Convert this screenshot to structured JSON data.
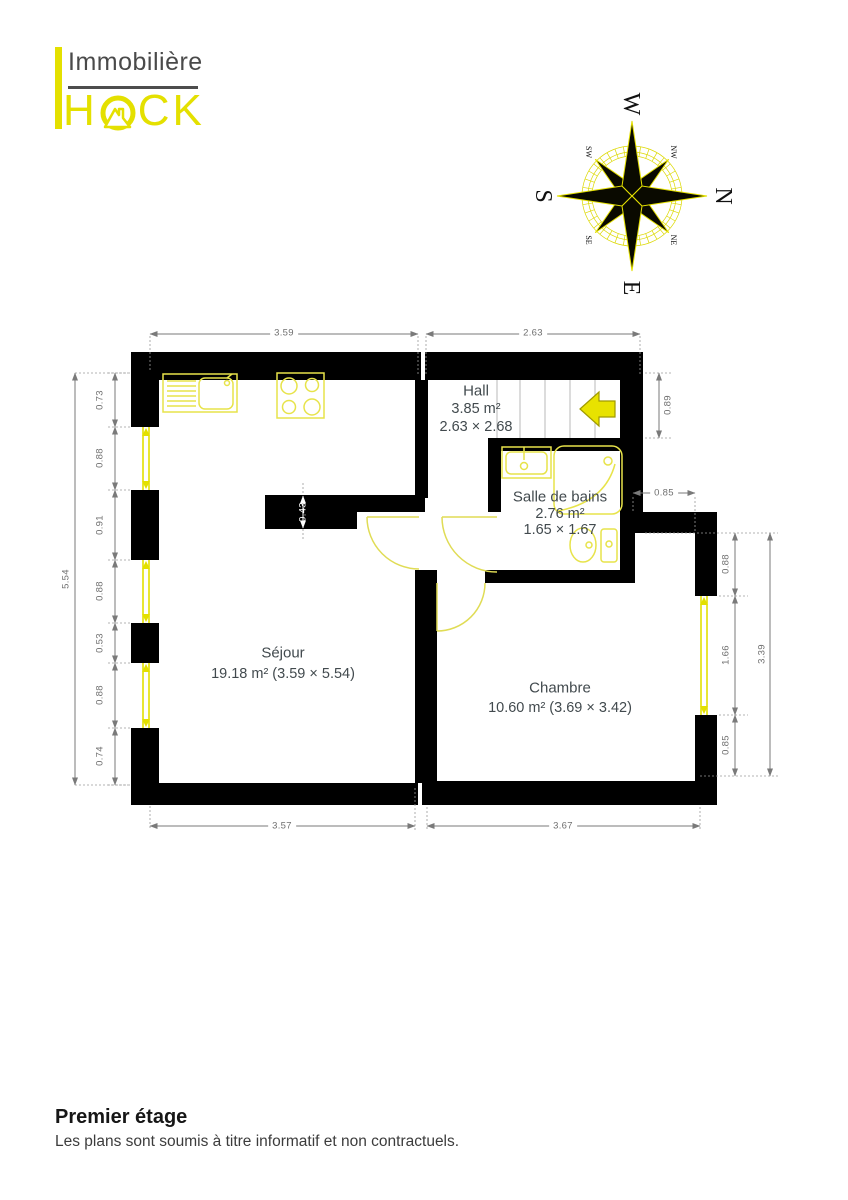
{
  "logo": {
    "line1": "Immobilière",
    "line2_h": "H",
    "line2_ck": "CK"
  },
  "compass": {
    "cardinals": [
      "N",
      "E",
      "S",
      "W"
    ],
    "intercardinals": [
      "NE",
      "SE",
      "SW",
      "NW"
    ]
  },
  "rooms": {
    "hall": {
      "name": "Hall",
      "area": "3.85 m²",
      "dims": "2.63 × 2.68"
    },
    "bath": {
      "name": "Salle de bains",
      "area": "2.76 m²",
      "dims": "1.65 × 1.67"
    },
    "sejour": {
      "name": "Séjour",
      "details": "19.18 m² (3.59 × 5.54)"
    },
    "chambre": {
      "name": "Chambre",
      "details": "10.60 m² (3.69 × 3.42)"
    }
  },
  "dimensions": {
    "top": [
      "3.59",
      "2.63"
    ],
    "bottom": [
      "3.57",
      "3.67"
    ],
    "left_total": "5.54",
    "left_chain": [
      "0.73",
      "0.88",
      "0.91",
      "0.88",
      "0.53",
      "0.88",
      "0.74"
    ],
    "right_stair": "0.89",
    "right_step": "0.85",
    "right_chain": [
      "0.88",
      "1.66",
      "0.85"
    ],
    "right_total": "3.39",
    "stub": "0.43"
  },
  "footer": {
    "title": "Premier étage",
    "disclaimer": "Les plans sont soumis à titre informatif et non contractuels."
  },
  "colors": {
    "yellow": "#e4e000",
    "wall": "#000000",
    "dim_line": "#7a7a7a",
    "room_text": "#424a4e"
  }
}
